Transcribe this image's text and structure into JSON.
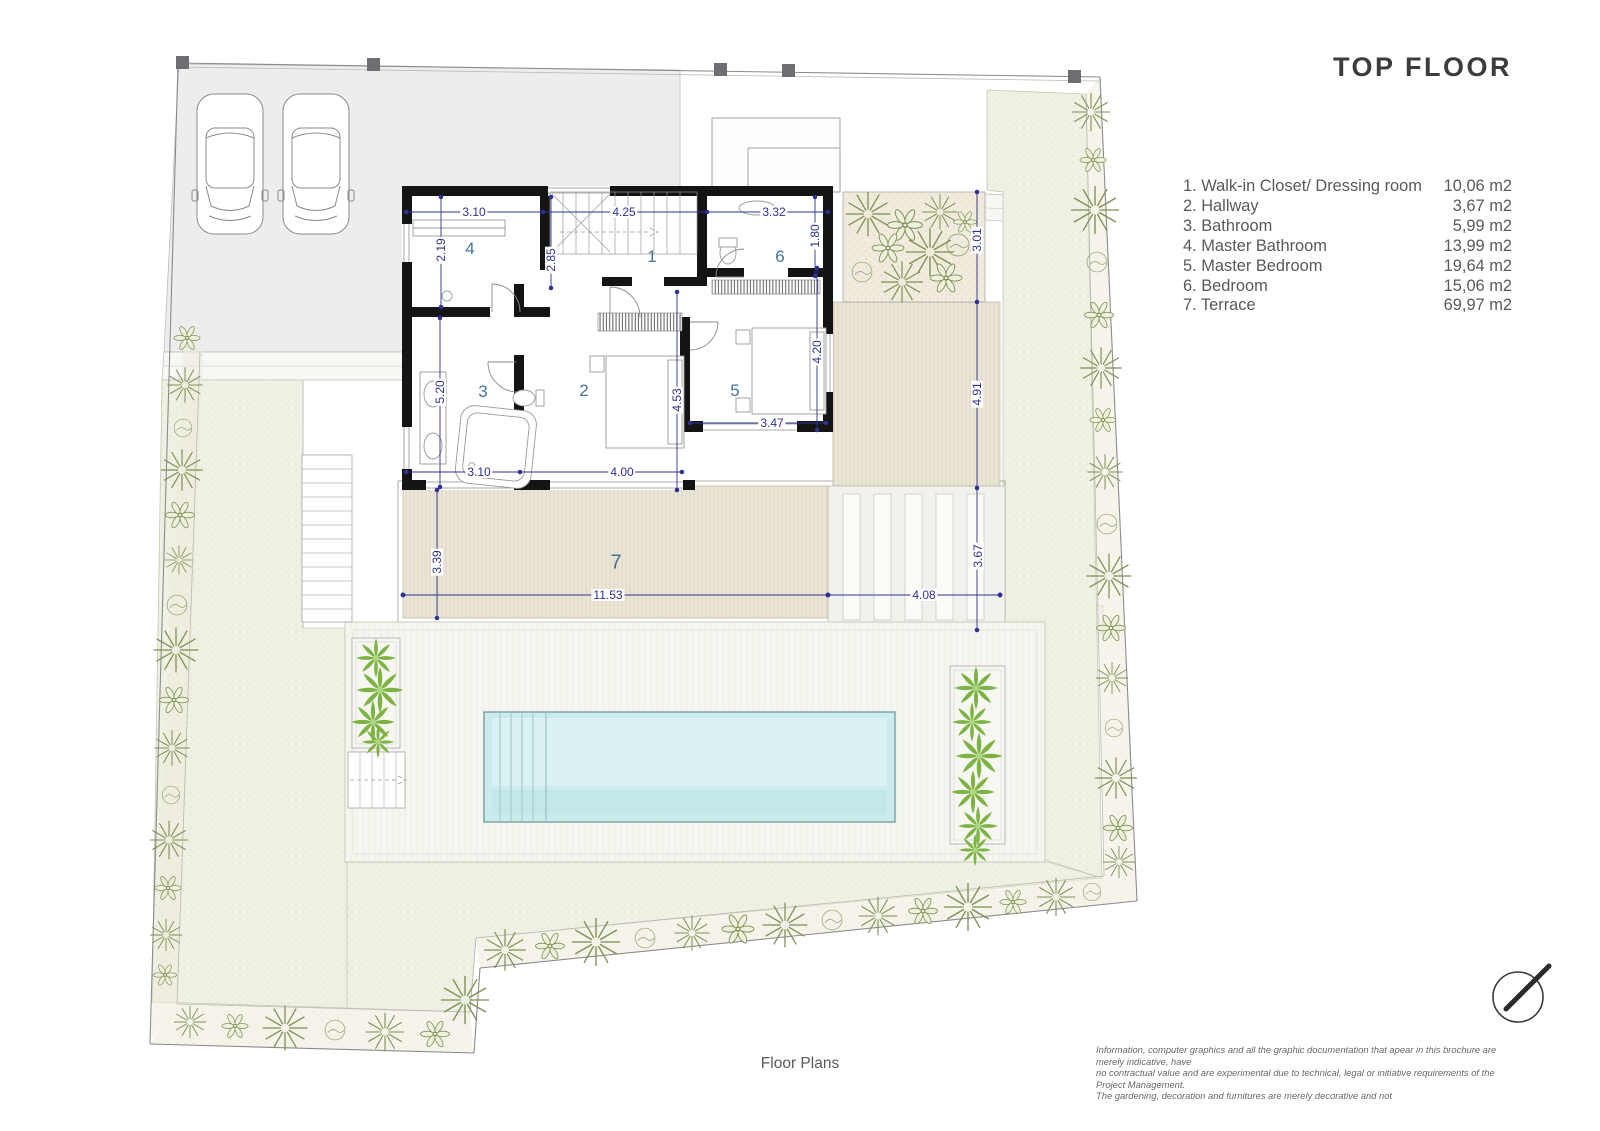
{
  "title": "TOP FLOOR",
  "legend": {
    "items": [
      {
        "label": "1. Walk-in Closet/ Dressing room",
        "area": "10,06 m2"
      },
      {
        "label": "2. Hallway",
        "area": "3,67 m2"
      },
      {
        "label": "3. Bathroom",
        "area": "5,99 m2"
      },
      {
        "label": "4. Master Bathroom",
        "area": "13,99 m2"
      },
      {
        "label": "5. Master Bedroom",
        "area": "19,64 m2"
      },
      {
        "label": "6. Bedroom",
        "area": "15,06 m2"
      },
      {
        "label": "7. Terrace",
        "area": "69,97 m2"
      }
    ]
  },
  "plan": {
    "rooms": {
      "n1": "1",
      "n2": "2",
      "n3": "3",
      "n4": "4",
      "n5": "5",
      "n6": "6",
      "n7": "7"
    },
    "dims": {
      "closet_width": "3.10",
      "closet_depth": "2.19",
      "stair_width": "4.25",
      "stair_depth": "2.85",
      "bath_top_width": "3.32",
      "bath_top_depth": "1.80",
      "patio_depth": "3.01",
      "bath_height": "5.20",
      "bedroom_height": "4.53",
      "master_height": "4.20",
      "master_width": "3.47",
      "bath_width": "3.10",
      "bedroom_width": "4.00",
      "deck_side_height": "4.91",
      "terrace_height": "3.39",
      "terrace_width": "11.53",
      "pergola_width": "4.08",
      "pergola_height": "3.67"
    }
  },
  "footer": {
    "caption": "Floor Plans",
    "disclaimer_line1": "Information, computer graphics and all the graphic documentation that apear in this brochure are merely indicative, have",
    "disclaimer_line2": "no contractual value and are experimental due to technical, legal or initiative requirements of the Project Management.",
    "disclaimer_line3": "The gardening, decoration and furnitures are merely decorative and not"
  },
  "colors": {
    "dimension": "#2e3192",
    "room_number": "#44749a",
    "wall": "#141414",
    "pool": "#cbecee",
    "lawn": "#eef1e3",
    "deck": "#ebe6d7",
    "plant_bright": "#7cb342",
    "plant_olive": "#7d8f52",
    "legend_text": "#58595b",
    "title_text": "#3c3c3e"
  }
}
